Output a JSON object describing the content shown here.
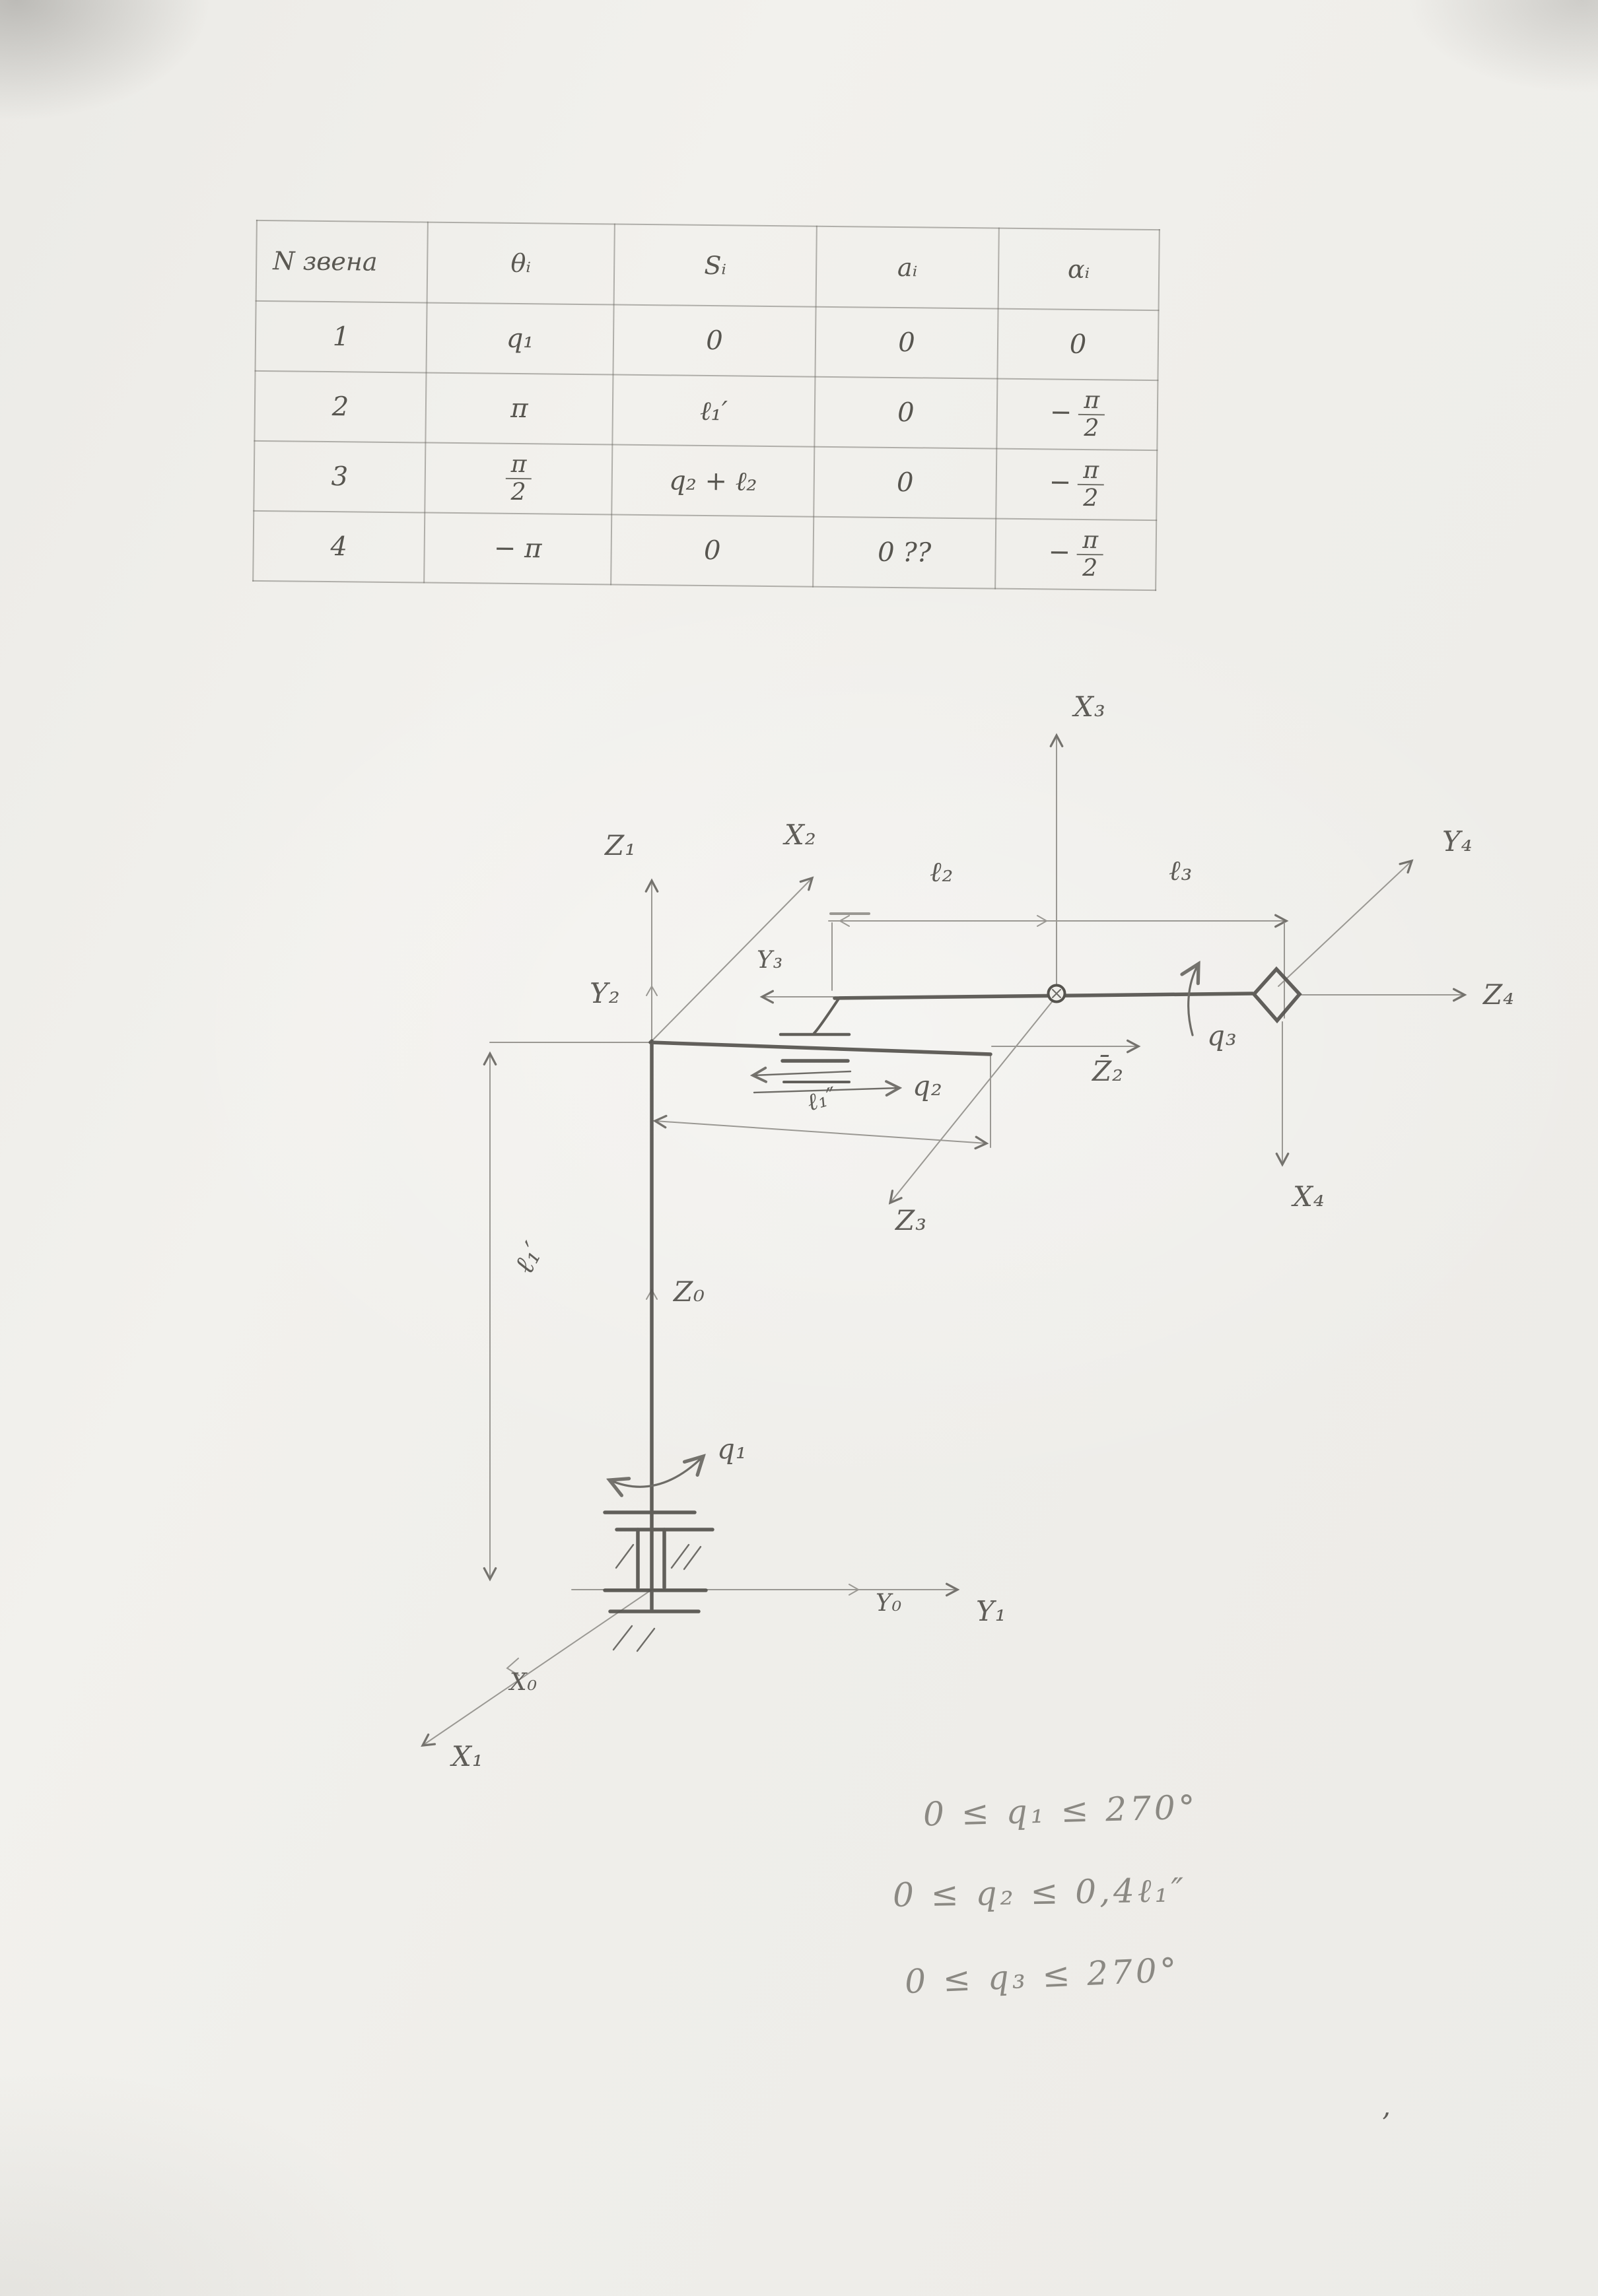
{
  "table": {
    "headers": [
      "N звена",
      "θᵢ",
      "Sᵢ",
      "aᵢ",
      "αᵢ"
    ],
    "rows": [
      [
        {
          "s": "1"
        },
        {
          "s": "q₁"
        },
        {
          "s": "0"
        },
        {
          "s": "0"
        },
        {
          "s": "0"
        }
      ],
      [
        {
          "s": "2"
        },
        {
          "s": "π"
        },
        {
          "s": "ℓ₁′"
        },
        {
          "s": "0"
        },
        {
          "neg": true,
          "frac": [
            "π",
            "2"
          ]
        }
      ],
      [
        {
          "s": "3"
        },
        {
          "frac": [
            "π",
            "2"
          ]
        },
        {
          "s": "q₂ + ℓ₂"
        },
        {
          "s": "0"
        },
        {
          "neg": true,
          "frac": [
            "π",
            "2"
          ]
        }
      ],
      [
        {
          "s": "4"
        },
        {
          "s": "− π"
        },
        {
          "s": "0"
        },
        {
          "s": "0 ??"
        },
        {
          "neg": true,
          "frac": [
            "π",
            "2"
          ]
        }
      ]
    ]
  },
  "diagram": {
    "axes": {
      "z1": "Z₁",
      "y2": "Y₂",
      "x2": "X₂",
      "x3": "X₃",
      "y3": "Y₃",
      "z0": "Z₀",
      "z2": "Z̄₂",
      "z3": "Z₃",
      "y4": "Y₄",
      "z4": "Z₄",
      "x4": "X₄",
      "y0": "Y₀",
      "y1": "Y₁",
      "x0": "X₀",
      "x1": "X₁"
    },
    "dims": {
      "l2": "ℓ₂",
      "l3": "ℓ₃",
      "l1_prime": "ℓ₁′",
      "l1_dprime": "ℓ₁″"
    },
    "joints": {
      "q1": "q₁",
      "q2": "q₂",
      "q3": "q₃"
    }
  },
  "constraints": {
    "lines": [
      "0 ≤ q₁ ≤ 270°",
      "0 ≤ q₂ ≤ 0,4ℓ₁″",
      "0 ≤ q₃ ≤ 270°"
    ]
  },
  "stray_mark": "’"
}
